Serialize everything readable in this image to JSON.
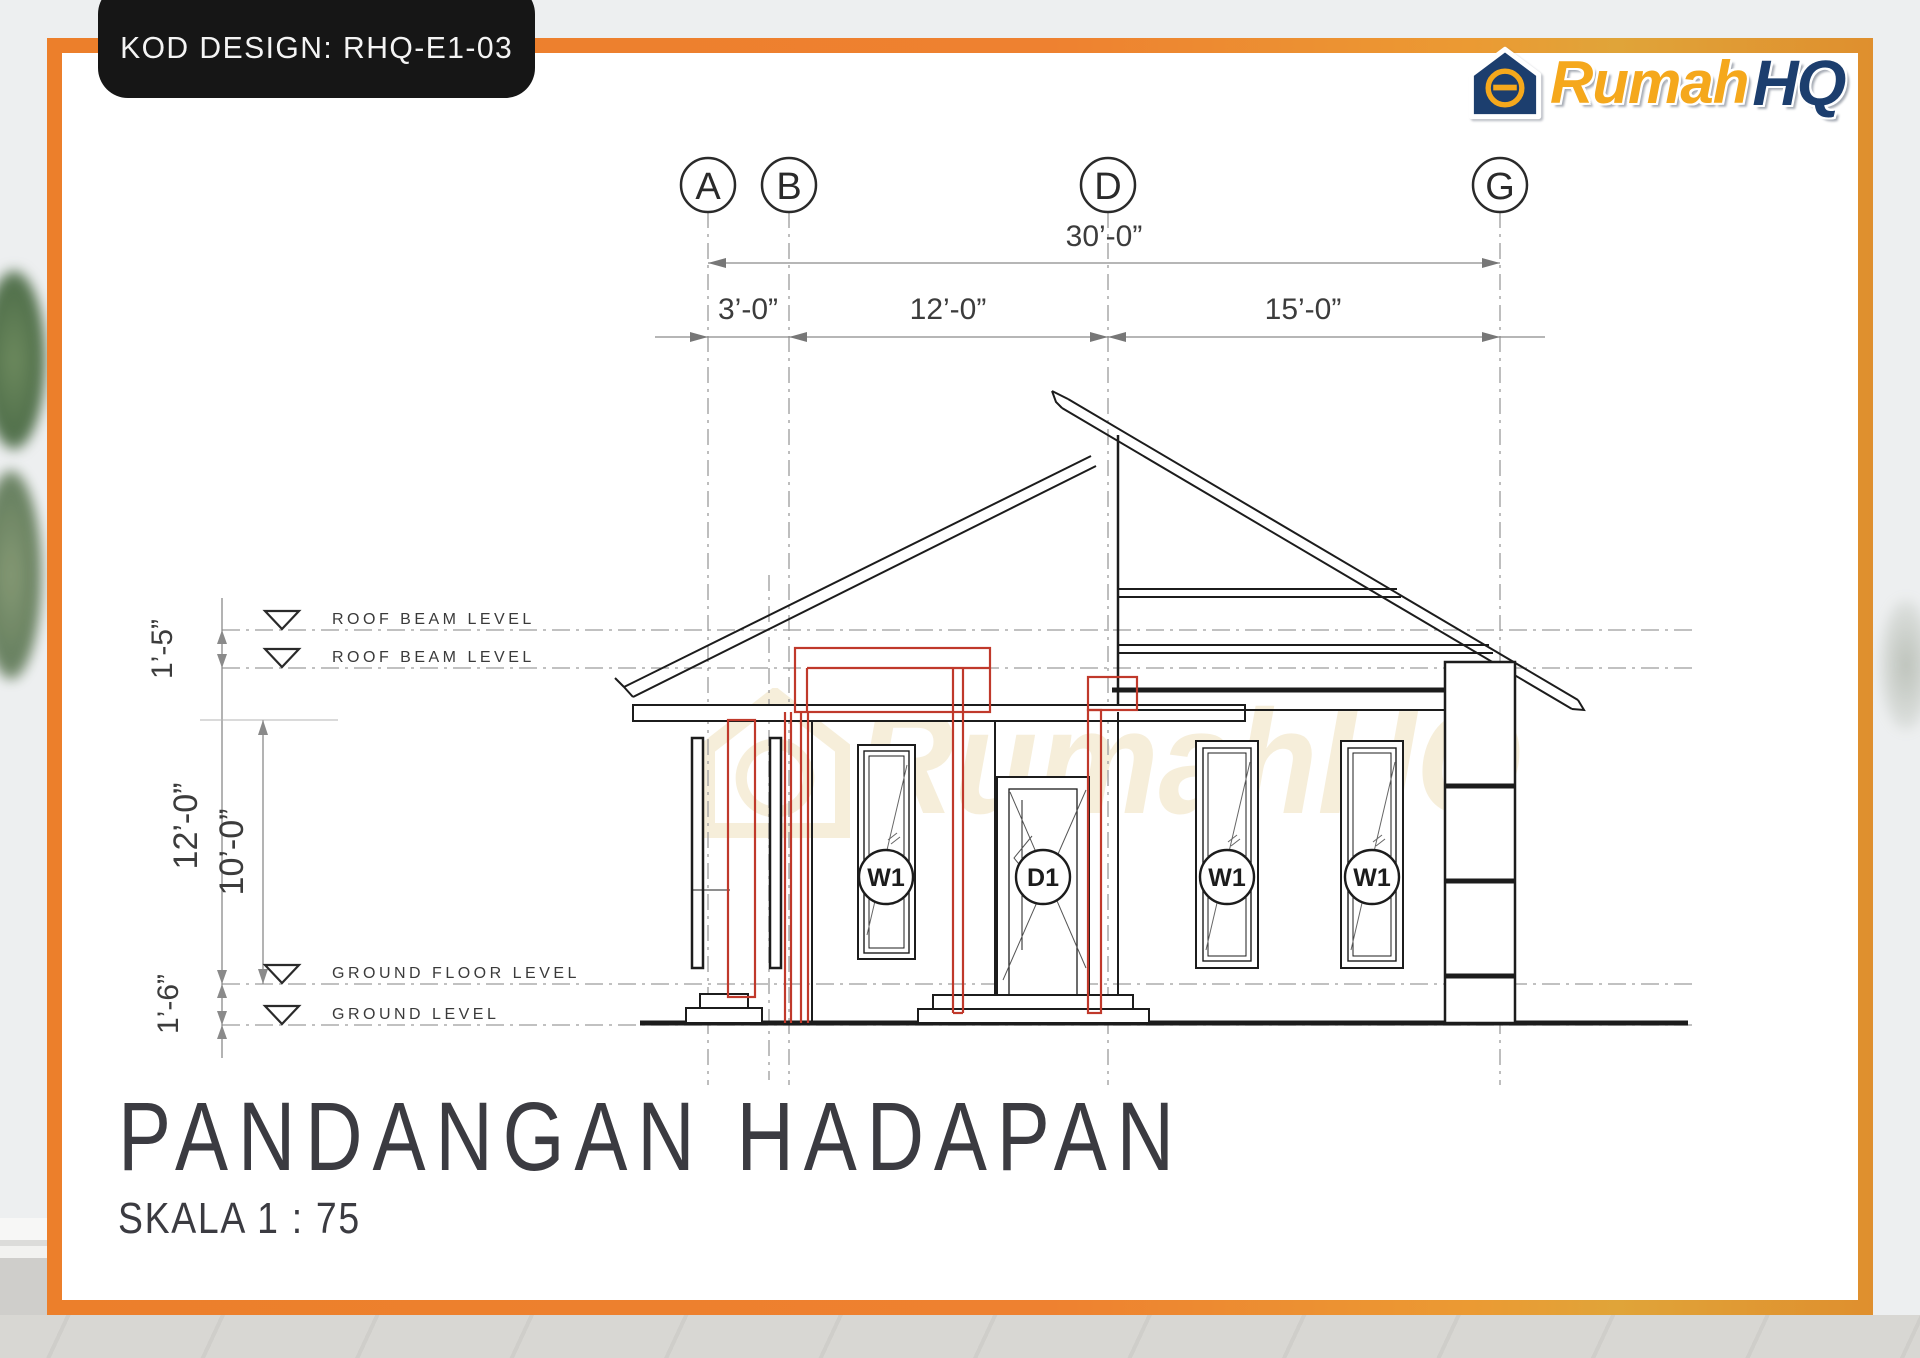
{
  "badge": {
    "label": "KOD DESIGN: RHQ-E1-03"
  },
  "logo": {
    "name": "Rumah",
    "suffix": "HQ"
  },
  "grid_columns": {
    "a": "A",
    "b": "B",
    "d": "D",
    "g": "G"
  },
  "dims": {
    "overall": "30’-0”",
    "seg1": "3’-0”",
    "seg2": "12’-0”",
    "seg3": "15’-0”",
    "v_roof_gap": "1’-5”",
    "v_wall": "12’-0”",
    "v_inner": "10’-0”",
    "v_plinth": "1’-6”"
  },
  "levels": {
    "roof_beam_1": "ROOF BEAM LEVEL",
    "roof_beam_2": "ROOF BEAM LEVEL",
    "ground_floor": "GROUND FLOOR LEVEL",
    "ground": "GROUND  LEVEL"
  },
  "openings": {
    "window_tag": "W1",
    "door_tag": "D1"
  },
  "titleblock": {
    "title": "PANDANGAN HADAPAN",
    "scale": "SKALA 1 : 75"
  },
  "watermark": {
    "text": "RumahHQ"
  },
  "colors": {
    "frame_orange": "#ec7f2b",
    "accent_red": "#c0392b",
    "logo_gold": "#f5a81c",
    "logo_navy": "#1c3e6e"
  }
}
